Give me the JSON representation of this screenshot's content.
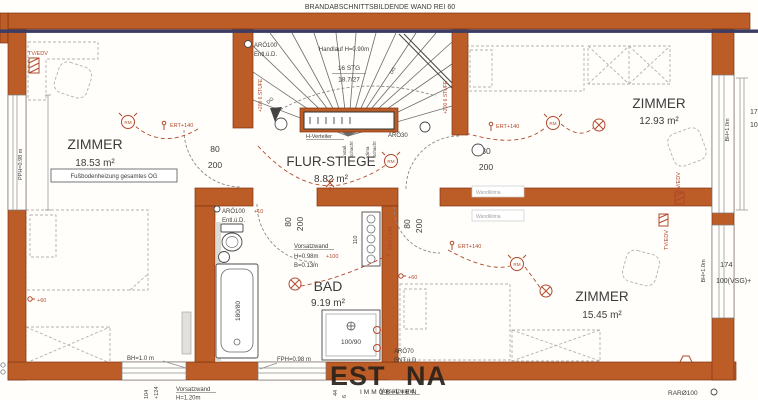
{
  "meta": {
    "fire_wall_note": "BRANDABSCHNITTSBILDENDE WAND REI 60"
  },
  "rooms": {
    "left": {
      "name": "ZIMMER",
      "area": "18.53 m²",
      "floor_note": "Fußbodenheizung gesamtes OG"
    },
    "flur": {
      "name": "FLUR-STIEGE",
      "area": "8.82 m²"
    },
    "top_right": {
      "name": "ZIMMER",
      "area": "12.93 m²"
    },
    "bad": {
      "name": "BAD",
      "area": "9.19 m²"
    },
    "bottom_right": {
      "name": "ZIMMER",
      "area": "15.45 m²"
    }
  },
  "stair": {
    "steps": "16 STG",
    "rise": "18.7/27",
    "handrail": "Handlauf H=0.90m",
    "level_note": "+200 6.STUFE",
    "to_floor": "DG",
    "distributor": "H-Verteiler",
    "shaft_a1": "Install.",
    "shaft_a2": "Schacht",
    "shaft_b1": "Klima",
    "shaft_b2": "Schacht"
  },
  "door": {
    "w": "80",
    "h": "200"
  },
  "vents": {
    "stair_duct": "ARÖ100",
    "stair_duct_note": "Entl.ü.D.",
    "bad_duct": "ARÖ100",
    "bad_duct_note": "Entl.ü.D.",
    "bad_duct_level": "+10",
    "flur_duct": "ARÖ30",
    "shower_duct": "ARÖ70",
    "shower_duct_note": "ENT.ü.D.",
    "roof_duct": "RARØ100"
  },
  "electro": {
    "ert": "ERT+140",
    "socket60": "+60",
    "rad_level": "+100",
    "rad_size": "110",
    "tv": "TV/EDV",
    "smoke": "RM",
    "ac": "Wandklima"
  },
  "windows": {
    "left": "PPH=0.98 m",
    "bottom_left": "BH=1.0 m",
    "bad": "FPH=0.98 m",
    "right": "BH=1.0m",
    "dim_w": "174",
    "dim_glass": "100(VSG)+",
    "dim_w2": "174",
    "dim_glass2": "100(VSG)"
  },
  "walls_info": {
    "vorsatz": "Vorsatzwand",
    "vorsatz_h": "H=0.98m",
    "vorsatz_b": "B=0.13m",
    "vorsatz_h2": "H=1.20m"
  },
  "fixtures": {
    "tub": "180/80",
    "shower": "100/90"
  },
  "levels": {
    "a": "104",
    "b": "+124",
    "c": "44",
    "d": "6"
  },
  "logo": {
    "l": "EST",
    "r": "NA",
    "sub": "IMMOBILIEN"
  },
  "colors": {
    "wall": "#bc5c27",
    "navy": "#3c3c64",
    "annotation": "#b0492c"
  }
}
